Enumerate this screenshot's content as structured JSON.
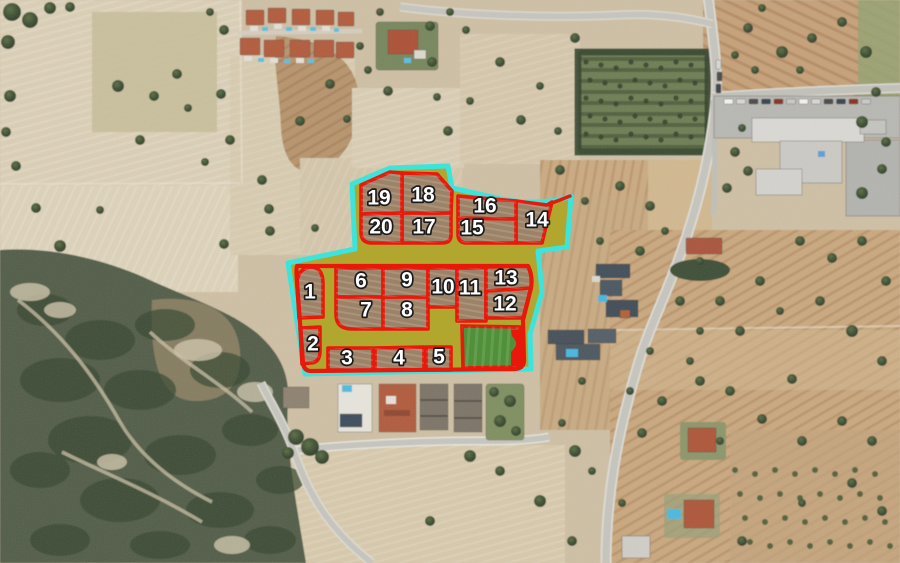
{
  "map_overlay": {
    "boundary_color": "#3ce4db",
    "plot_line_color": "#e8180b",
    "common_area_color": "#b1a72e",
    "plot_fill_color": "#9c8368",
    "green_area_color": "#4f9038",
    "reserved_red_color": "#e8180b",
    "label_color": "#ffffff",
    "label_outline_color": "#1b1b1b",
    "plots": [
      {
        "number": "1",
        "cx": 310,
        "cy": 292
      },
      {
        "number": "2",
        "cx": 313,
        "cy": 344
      },
      {
        "number": "3",
        "cx": 347,
        "cy": 358
      },
      {
        "number": "4",
        "cx": 399,
        "cy": 358
      },
      {
        "number": "5",
        "cx": 439,
        "cy": 357
      },
      {
        "number": "6",
        "cx": 361,
        "cy": 281
      },
      {
        "number": "7",
        "cx": 366,
        "cy": 310
      },
      {
        "number": "8",
        "cx": 407,
        "cy": 310
      },
      {
        "number": "9",
        "cx": 407,
        "cy": 280
      },
      {
        "number": "10",
        "cx": 443,
        "cy": 287
      },
      {
        "number": "11",
        "cx": 470,
        "cy": 288
      },
      {
        "number": "12",
        "cx": 505,
        "cy": 304
      },
      {
        "number": "13",
        "cx": 506,
        "cy": 278
      },
      {
        "number": "14",
        "cx": 537,
        "cy": 220
      },
      {
        "number": "15",
        "cx": 472,
        "cy": 228
      },
      {
        "number": "16",
        "cx": 485,
        "cy": 206
      },
      {
        "number": "17",
        "cx": 424,
        "cy": 227
      },
      {
        "number": "18",
        "cx": 423,
        "cy": 195
      },
      {
        "number": "19",
        "cx": 379,
        "cy": 198
      },
      {
        "number": "20",
        "cx": 381,
        "cy": 227
      }
    ]
  }
}
